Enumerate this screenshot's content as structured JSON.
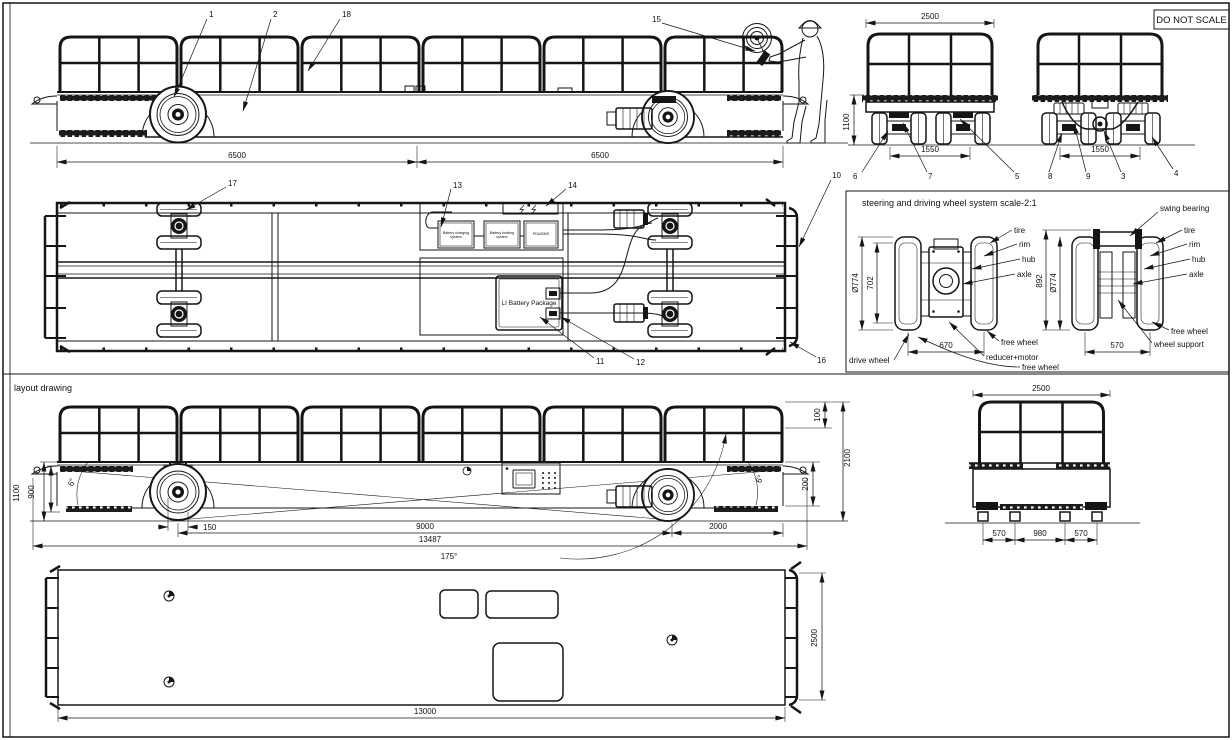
{
  "sheet": {
    "do_not_scale": "DO NOT SCALE",
    "layout_drawing_label": "layout drawing"
  },
  "callouts": {
    "c1": "1",
    "c2": "2",
    "c3": "3",
    "c4": "4",
    "c5": "5",
    "c6": "6",
    "c7": "7",
    "c8": "8",
    "c9": "9",
    "c10": "10",
    "c11": "11",
    "c12": "12",
    "c13": "13",
    "c14": "14",
    "c15": "15",
    "c16": "16",
    "c17": "17",
    "c18": "18"
  },
  "top_side_view": {
    "dim_front": "6500",
    "dim_rear": "6500"
  },
  "end_views": {
    "width": "2500",
    "height": "1100",
    "track_left": "1550",
    "track_right": "1550"
  },
  "equipment": {
    "battery_charging": "Battery charging system",
    "battery_heating": "Battery heating system",
    "pdu_bms": "PDU/BMS",
    "li_battery": "LI Battery Package"
  },
  "detail": {
    "title": "steering and driving wheel system  scale-2:1",
    "labels": {
      "tire": "tire",
      "rim": "rim",
      "hub": "hub",
      "axle": "axle",
      "swing_bearing": "swing bearing",
      "free_wheel": "free wheel",
      "wheel_support": "wheel support",
      "drive_wheel": "drive wheel",
      "reducer_motor": "reducer+motor"
    },
    "dims": {
      "dia_left": "Ø774",
      "rim_left": "702",
      "height_right": "892",
      "dia_right": "Ø774",
      "span_left": "670",
      "span_right": "570"
    }
  },
  "layout": {
    "dims": {
      "h1100": "1100",
      "h900": "900",
      "angle_front": "6°",
      "offset150": "150",
      "wheelbase": "9000",
      "total": "13487",
      "breakover": "175°",
      "rail100": "100",
      "h2100": "2100",
      "step200": "200",
      "rear2000": "2000",
      "angle_rear": "6°"
    }
  },
  "layout_end": {
    "width": "2500",
    "a": "570",
    "b": "980",
    "c": "570"
  },
  "bottom_plan": {
    "length": "13000",
    "width": "2500"
  }
}
